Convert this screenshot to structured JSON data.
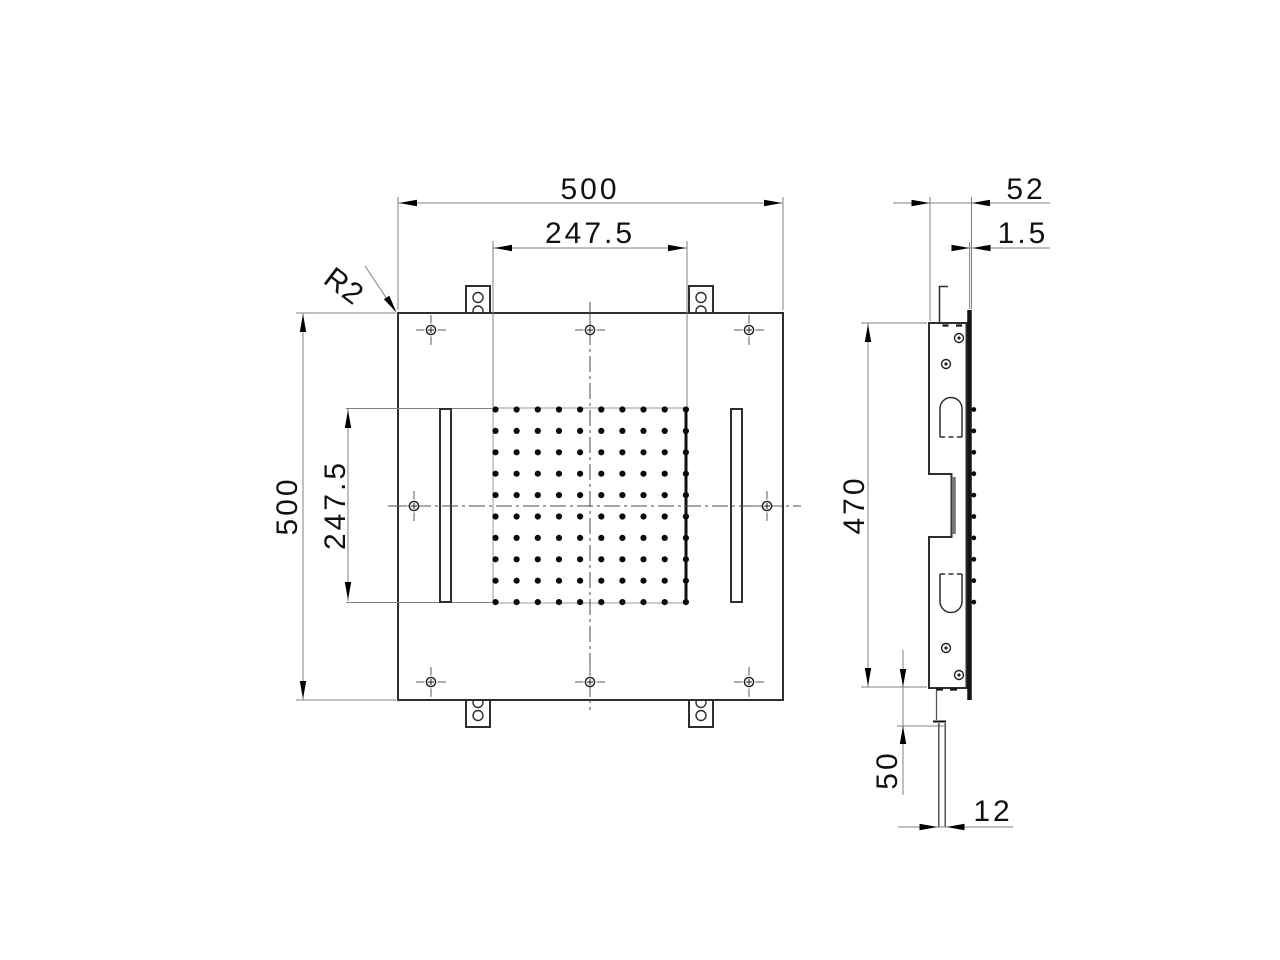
{
  "front_view": {
    "dim_overall_width": "500",
    "dim_hole_pattern_width": "247.5",
    "dim_overall_height": "500",
    "dim_hole_pattern_height": "247.5",
    "corner_radius_label": "R2",
    "perforation_grid": {
      "rows": 10,
      "cols": 10
    }
  },
  "side_view": {
    "dim_overall_depth": "52",
    "dim_panel_thickness": "1.5",
    "dim_bracket_height": "470",
    "dim_tab_drop": "50",
    "dim_tab_width": "12"
  }
}
